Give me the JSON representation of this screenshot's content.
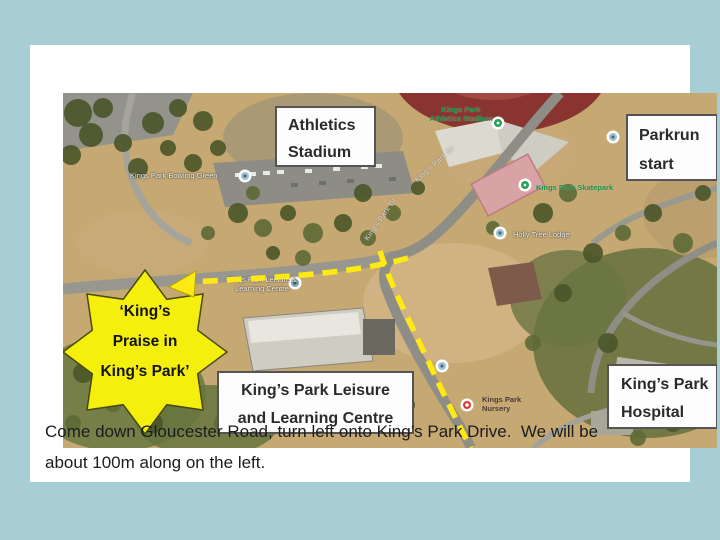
{
  "window": {
    "background": "#a6ced3"
  },
  "map": {
    "callouts": {
      "athletics": {
        "line1": "Athletics",
        "line2": "Stadium"
      },
      "parkrun": {
        "line1": "Parkrun",
        "line2": "start"
      },
      "leisure": {
        "line1": "King’s Park Leisure",
        "line2": "and Learning Centre"
      },
      "hospital": {
        "line1": "King’s Park",
        "line2": "Hospital"
      }
    },
    "star": {
      "line1": "‘King’s",
      "line2": "Praise in",
      "line3": "King’s Park’"
    },
    "poi_labels": {
      "bowling": "Kings Park Bowling Green",
      "athletics1": "Kings Park",
      "athletics2": "Athletics Stadium",
      "skatepark": "Kings Park Skatepark",
      "holly": "Holly Tree Lodge",
      "leisure1": "Kings Park Leisure &",
      "leisure2": "Learning Centre",
      "club1": "Kings Park",
      "club2": "Nursery",
      "road1": "King’s Park Dr",
      "road2": "King’s Park Dr"
    }
  },
  "caption": {
    "line1": "Come down Gloucester Road, turn left onto King’s Park Drive.  We will be",
    "line2": "about 100m along on the left."
  },
  "colors": {
    "route_yellow": "#ffe912",
    "star_yellow": "#f4ef0c",
    "callout_border": "#545454",
    "background_blue": "#a6ced3"
  }
}
